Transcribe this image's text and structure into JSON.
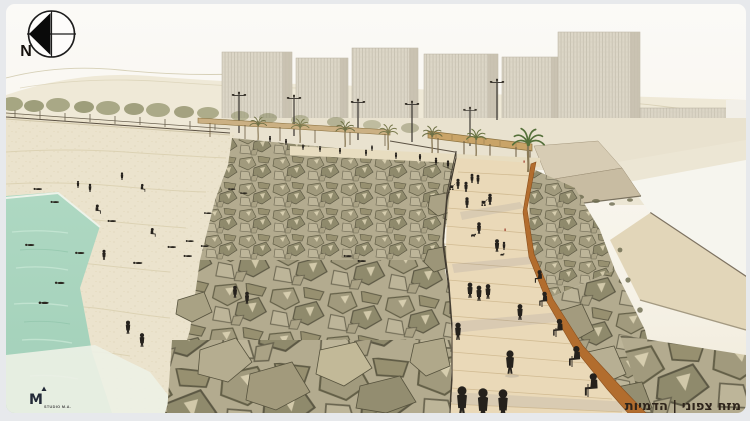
{
  "compass": {
    "label": "N"
  },
  "caption": {
    "text": "מזח צפוני | הדמיות"
  },
  "logo": {
    "mark": "M",
    "studio": "STUDIO M.A."
  },
  "palette": {
    "frame": "#e7e9ec",
    "sky": "#f8f6f0",
    "sand": "#ebe3cd",
    "water": "#a8d5bf",
    "rock": "#a59d81",
    "rock_shadow": "#5f5b45",
    "deck": "#ead9b8",
    "corten_rail": "#b26d2e",
    "pergola_wood": "#cbb083",
    "building": "#dcd6c7",
    "palm_green": "#55703a",
    "palm_olive": "#6e7046",
    "people_silhouette": "#25211c",
    "caption_ink": "#2e241b"
  }
}
